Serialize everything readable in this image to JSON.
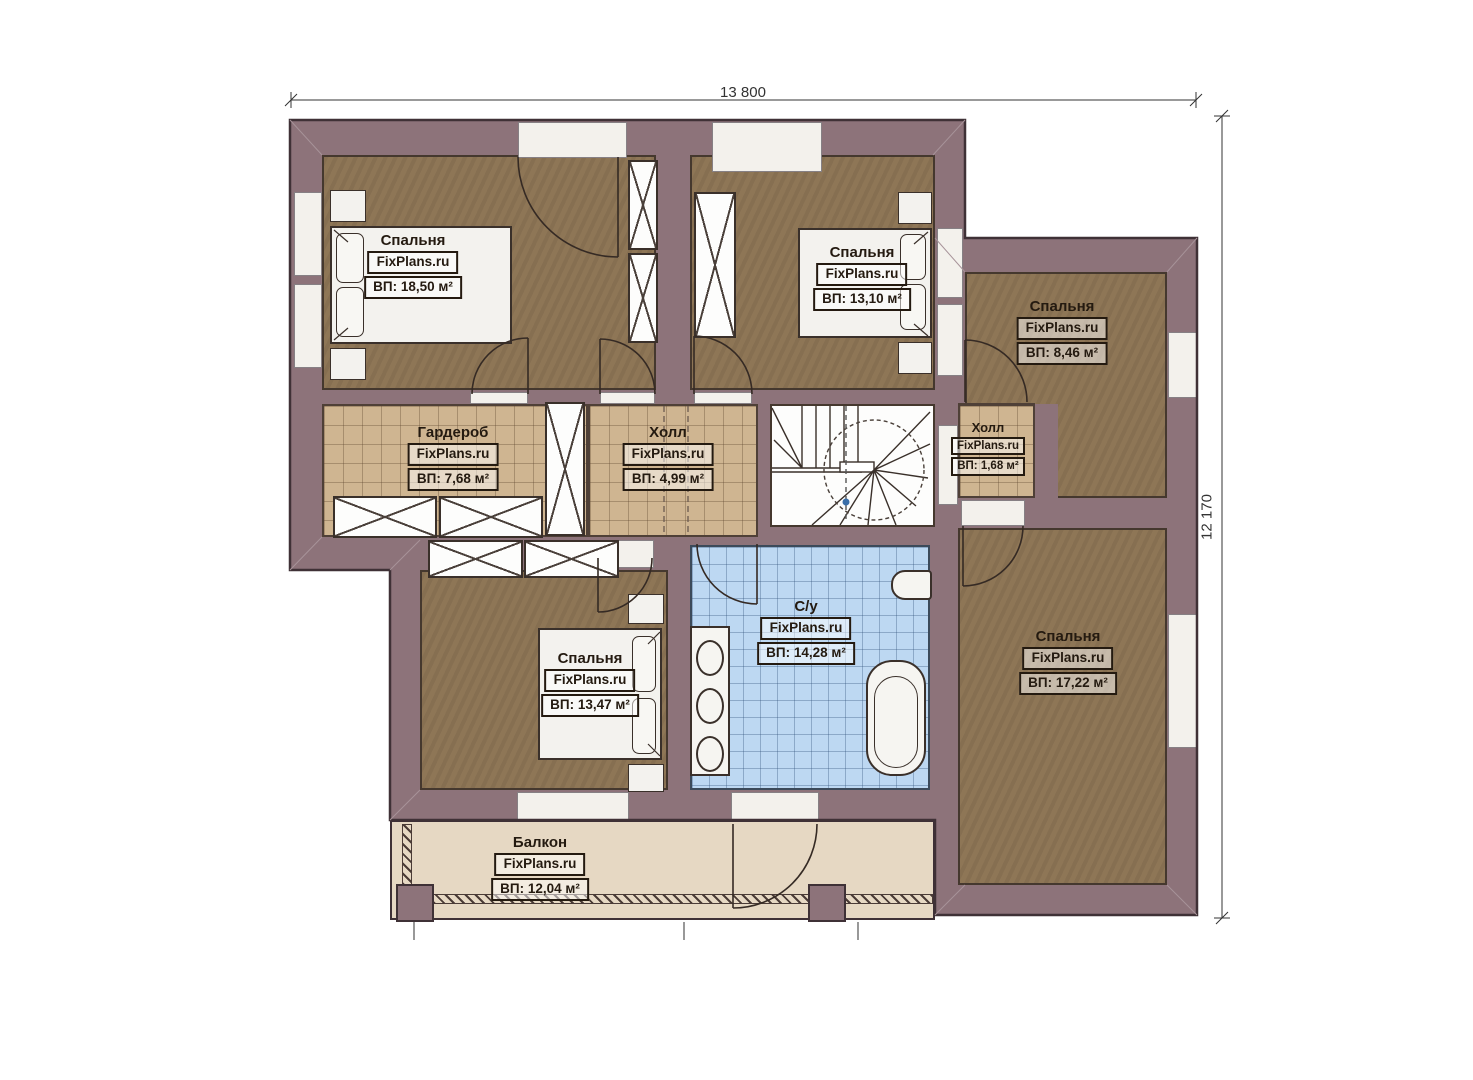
{
  "plan": {
    "dimensions": {
      "top": "13 800",
      "right": "12 170"
    },
    "rooms": [
      {
        "id": "bedroom-1",
        "name": "Спальня",
        "brand": "FixPlans.ru",
        "area": "ВП: 18,50 м²"
      },
      {
        "id": "bedroom-2",
        "name": "Спальня",
        "brand": "FixPlans.ru",
        "area": "ВП: 13,10 м²"
      },
      {
        "id": "bedroom-3",
        "name": "Спальня",
        "brand": "FixPlans.ru",
        "area": "ВП: 8,46 м²"
      },
      {
        "id": "wardrobe",
        "name": "Гардероб",
        "brand": "FixPlans.ru",
        "area": "ВП: 7,68 м²"
      },
      {
        "id": "hall-main",
        "name": "Холл",
        "brand": "FixPlans.ru",
        "area": "ВП: 4,99 м²"
      },
      {
        "id": "hall-small",
        "name": "Холл",
        "brand": "FixPlans.ru",
        "area": "ВП: 1,68 м²"
      },
      {
        "id": "bedroom-4",
        "name": "Спальня",
        "brand": "FixPlans.ru",
        "area": "ВП: 13,47 м²"
      },
      {
        "id": "bathroom",
        "name": "С/у",
        "brand": "FixPlans.ru",
        "area": "ВП: 14,28 м²"
      },
      {
        "id": "bedroom-5",
        "name": "Спальня",
        "brand": "FixPlans.ru",
        "area": "ВП: 17,22 м²"
      },
      {
        "id": "balcony",
        "name": "Балкон",
        "brand": "FixPlans.ru",
        "area": "ВП: 12,04 м²"
      }
    ],
    "colors": {
      "wall": "#8d737a",
      "wood_floor": "#8e7656",
      "tan_tile": "#cfb591",
      "blue_tile": "#bdd8f2",
      "balcony_floor": "#e6d8c3",
      "outline": "#3f3136"
    }
  }
}
